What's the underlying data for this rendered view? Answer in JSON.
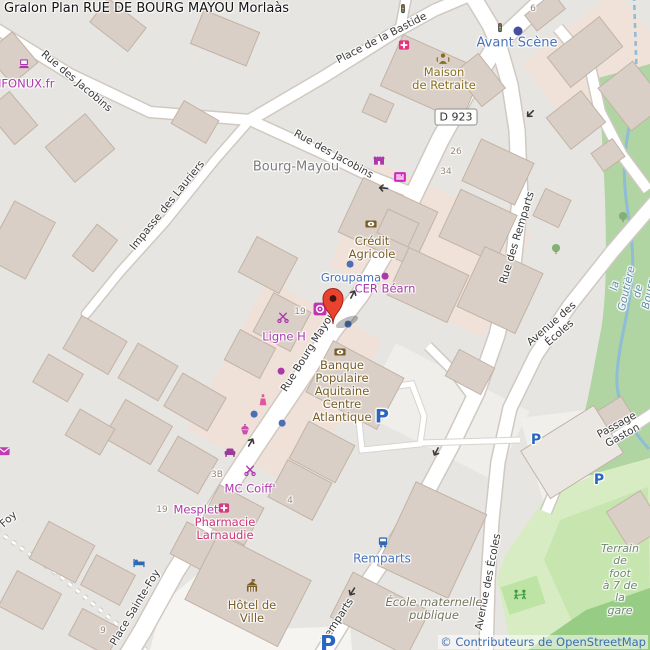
{
  "title": "Gralon Plan RUE DE BOURG MAYOU Morlaàs",
  "attribution": "© Contributeurs de OpenStreetMap",
  "road_shield": {
    "text": "D 923",
    "x": 456,
    "y": 117
  },
  "palette": {
    "shop_purple": "#ac39ac",
    "amenity_brown": "#7a5c25",
    "transport_blue": "#4a72b8",
    "pharmacy_pink": "#cc3377",
    "water_blue": "#5f8ca8",
    "marker_red": "#e7432e",
    "parking_blue": "#2a66c0",
    "attribution_blue": "#3b6eb5"
  },
  "labels": [
    {
      "name": "street-rue-des-jacobins-nw",
      "text": "Rue des Jacobins",
      "x": 76,
      "y": 82,
      "rot": 40,
      "color": "#3a3a3a",
      "size": 10.5
    },
    {
      "name": "street-impasse-des-lauriers",
      "text": "Impasse des Lauriers",
      "x": 168,
      "y": 206,
      "rot": -51,
      "color": "#3a3a3a",
      "size": 10.5
    },
    {
      "name": "street-place-de-la-bastide",
      "text": "Place de la Bastide",
      "x": 382,
      "y": 39,
      "rot": -27,
      "color": "#3a3a3a",
      "size": 10.5
    },
    {
      "name": "street-rue-des-jacobins-se",
      "text": "Rue des Jacobins",
      "x": 333,
      "y": 155,
      "rot": 29,
      "color": "#3a3a3a",
      "size": 10.5
    },
    {
      "name": "street-rue-bourg-mayou",
      "text": "Rue Bourg Mayou",
      "x": 309,
      "y": 352,
      "rot": -58,
      "color": "#3a3a3a",
      "size": 10.5
    },
    {
      "name": "street-place-sainte-foy",
      "text": "Place Sainte-Foy",
      "x": 136,
      "y": 608,
      "rot": -59,
      "color": "#3a3a3a",
      "size": 10.5
    },
    {
      "name": "street-foy",
      "text": "Foy",
      "x": 9,
      "y": 520,
      "rot": -42,
      "color": "#3a3a3a",
      "size": 10.5
    },
    {
      "name": "street-rue-des-remparts",
      "text": "Rue des Remparts",
      "x": 518,
      "y": 238,
      "rot": -73,
      "color": "#3a3a3a",
      "size": 10.5
    },
    {
      "name": "street-remparts",
      "text": "Remparts",
      "x": 338,
      "y": 621,
      "rot": -57,
      "color": "#3a3a3a",
      "size": 10.5
    },
    {
      "name": "street-avenue-des-ecoles-mid",
      "text": "Avenue des Écoles",
      "x": 556,
      "y": 329,
      "rot": -41,
      "color": "#3a3a3a",
      "size": 10.5
    },
    {
      "name": "street-avenue-des-ecoles-south",
      "text": "Avenue des Écoles",
      "x": 489,
      "y": 582,
      "rot": -79,
      "color": "#3a3a3a",
      "size": 10.5
    },
    {
      "name": "street-passage-gaston",
      "text": "Passage Gaston",
      "x": 620,
      "y": 431,
      "rot": -29,
      "color": "#3a3a3a",
      "size": 10.5
    },
    {
      "name": "place-bourg-mayou",
      "text": "Bourg-Mayou",
      "x": 296,
      "y": 168,
      "rot": 0,
      "color": "#7d7d7d",
      "size": 13
    },
    {
      "name": "poi-enfonux",
      "text": "ENFONUX.fr",
      "x": 20,
      "y": 84,
      "rot": 0,
      "color": "#ac39ac",
      "size": 11.5
    },
    {
      "name": "poi-avant-scene",
      "text": "Avant Scène",
      "x": 517,
      "y": 44,
      "rot": 0,
      "color": "#4a72b8",
      "size": 13
    },
    {
      "name": "poi-maison-de-retraite",
      "text": "Maison\nde Retraite",
      "x": 444,
      "y": 79,
      "rot": 0,
      "color": "#8a6d1f",
      "size": 11.5
    },
    {
      "name": "poi-credit-agricole",
      "text": "Crédit\nAgricole",
      "x": 372,
      "y": 248,
      "rot": 0,
      "color": "#7a5c25",
      "size": 11.5
    },
    {
      "name": "poi-groupama",
      "text": "Groupama",
      "x": 351,
      "y": 278,
      "rot": 0,
      "color": "#4a72b8",
      "size": 11.5
    },
    {
      "name": "poi-cer-bearn",
      "text": "CER Béarn",
      "x": 385,
      "y": 289,
      "rot": 0,
      "color": "#ac39ac",
      "size": 11.5
    },
    {
      "name": "poi-ligne-h",
      "text": "Ligne H",
      "x": 284,
      "y": 337,
      "rot": 0,
      "color": "#ac39ac",
      "size": 11.5
    },
    {
      "name": "poi-banque-populaire",
      "text": "Banque\nPopulaire\nAquitaine\nCentre\nAtlantique",
      "x": 342,
      "y": 391,
      "rot": 0,
      "color": "#7a5c25",
      "size": 11.5
    },
    {
      "name": "poi-mc-coiff",
      "text": "MC Coiff'",
      "x": 250,
      "y": 489,
      "rot": 0,
      "color": "#ac39ac",
      "size": 11.5
    },
    {
      "name": "poi-mesplet",
      "text": "Mesplet",
      "x": 196,
      "y": 510,
      "rot": 0,
      "color": "#ac39ac",
      "size": 11.5
    },
    {
      "name": "poi-pharmacie-larnaudie",
      "text": "Pharmacie\nLarnaudie",
      "x": 225,
      "y": 529,
      "rot": 0,
      "color": "#cc3377",
      "size": 11.5
    },
    {
      "name": "poi-hotel-de-ville",
      "text": "Hôtel de\nVille",
      "x": 252,
      "y": 612,
      "rot": 0,
      "color": "#7a5c25",
      "size": 11.5
    },
    {
      "name": "bus-stop-remparts",
      "text": "Remparts",
      "x": 382,
      "y": 559,
      "rot": 0,
      "color": "#4a72b8",
      "size": 12
    },
    {
      "name": "poi-ecole-maternelle",
      "text": "École maternelle\npublique",
      "x": 434,
      "y": 609,
      "rot": 0,
      "color": "#75755f",
      "size": 11.5,
      "italic": true
    },
    {
      "name": "poi-terrain-de-foot",
      "text": "Terrain\nde foot\nà 7 de la\ngare",
      "x": 620,
      "y": 580,
      "rot": 0,
      "color": "#6f8a6f",
      "size": 11,
      "italic": true
    },
    {
      "name": "water-la-goutiere",
      "text": "la Goutière de Bourg",
      "x": 633,
      "y": 290,
      "rot": -77,
      "color": "#5f8ca8",
      "size": 10.5,
      "italic": true
    },
    {
      "name": "housenumber",
      "text": "6",
      "x": 533,
      "y": 9,
      "rot": 0,
      "color": "#998877",
      "size": 9
    },
    {
      "name": "housenumber",
      "text": "26",
      "x": 456,
      "y": 152,
      "rot": 0,
      "color": "#998877",
      "size": 9
    },
    {
      "name": "housenumber",
      "text": "34",
      "x": 446,
      "y": 172,
      "rot": 0,
      "color": "#998877",
      "size": 9
    },
    {
      "name": "housenumber",
      "text": "19",
      "x": 300,
      "y": 312,
      "rot": 0,
      "color": "#998877",
      "size": 9
    },
    {
      "name": "housenumber",
      "text": "19",
      "x": 162,
      "y": 510,
      "rot": 0,
      "color": "#998877",
      "size": 9
    },
    {
      "name": "housenumber",
      "text": "3B",
      "x": 217,
      "y": 475,
      "rot": 0,
      "color": "#998877",
      "size": 9
    },
    {
      "name": "housenumber",
      "text": "4",
      "x": 290,
      "y": 501,
      "rot": 0,
      "color": "#998877",
      "size": 9
    },
    {
      "name": "housenumber",
      "text": "9",
      "x": 103,
      "y": 631,
      "rot": 0,
      "color": "#998877",
      "size": 9
    },
    {
      "name": "parking-p",
      "text": "P",
      "x": 382,
      "y": 417,
      "rot": 0,
      "color": "#2a66c0",
      "size": 19,
      "bold": true
    },
    {
      "name": "parking-p",
      "text": "P",
      "x": 536,
      "y": 441,
      "rot": 0,
      "color": "#2a66c0",
      "size": 14,
      "bold": true
    },
    {
      "name": "parking-p",
      "text": "P",
      "x": 599,
      "y": 481,
      "rot": 0,
      "color": "#2a66c0",
      "size": 14,
      "bold": true
    },
    {
      "name": "parking-p",
      "text": "P",
      "x": 328,
      "y": 646,
      "rot": 0,
      "color": "#2a66c0",
      "size": 22,
      "bold": true
    }
  ],
  "icons": [
    {
      "name": "laptop-icon",
      "x": 24,
      "y": 64
    },
    {
      "name": "clinic-icon",
      "x": 404,
      "y": 45
    },
    {
      "name": "social-facility-icon",
      "x": 443,
      "y": 59,
      "s": 15
    },
    {
      "name": "traffic-light-icon",
      "x": 403,
      "y": 9,
      "s": 11
    },
    {
      "name": "traffic-light-icon",
      "x": 500,
      "y": 28,
      "s": 11
    },
    {
      "name": "shop-awning-icon",
      "x": 379,
      "y": 160
    },
    {
      "name": "newsagent-icon",
      "x": 400,
      "y": 177,
      "s": 15
    },
    {
      "name": "bank-icon",
      "x": 371,
      "y": 224
    },
    {
      "name": "bank-icon",
      "x": 340,
      "y": 352
    },
    {
      "name": "hairdresser-icon",
      "x": 283,
      "y": 317
    },
    {
      "name": "convenience-icon",
      "x": 320,
      "y": 309,
      "s": 15
    },
    {
      "name": "beauty-icon",
      "x": 263,
      "y": 400
    },
    {
      "name": "bakery-icon",
      "x": 245,
      "y": 429
    },
    {
      "name": "furniture-icon",
      "x": 230,
      "y": 452
    },
    {
      "name": "post-icon",
      "x": 4,
      "y": 451
    },
    {
      "name": "hairdresser-icon",
      "x": 250,
      "y": 470
    },
    {
      "name": "pharmacy-icon",
      "x": 224,
      "y": 508
    },
    {
      "name": "hotel-icon",
      "x": 139,
      "y": 562
    },
    {
      "name": "townhall-icon",
      "x": 252,
      "y": 587,
      "s": 16
    },
    {
      "name": "bus-stop-icon",
      "x": 383,
      "y": 542,
      "s": 12
    },
    {
      "name": "playground-icon",
      "x": 520,
      "y": 594,
      "s": 16
    },
    {
      "name": "tree-icon",
      "x": 623,
      "y": 217
    },
    {
      "name": "tree-icon",
      "x": 556,
      "y": 249
    },
    {
      "name": "marker-pin",
      "x": 333,
      "y": 324
    }
  ],
  "dots": [
    {
      "x": 350,
      "y": 264,
      "color": "#4a6fb5",
      "r": 3.4
    },
    {
      "x": 348,
      "y": 324,
      "color": "#4a6fb5",
      "r": 3.4
    },
    {
      "x": 254,
      "y": 414,
      "color": "#4a6fb5",
      "r": 3.4
    },
    {
      "x": 282,
      "y": 423,
      "color": "#4a6fb5",
      "r": 3.4
    },
    {
      "x": 518,
      "y": 31,
      "color": "#454f9c",
      "r": 4.5
    },
    {
      "x": 385,
      "y": 276,
      "color": "#ac39ac",
      "r": 3.4
    },
    {
      "x": 281,
      "y": 371,
      "color": "#ac39ac",
      "r": 3.4
    }
  ],
  "oneway_arrows": [
    {
      "x": 353,
      "y": 294,
      "rot": -62
    },
    {
      "x": 251,
      "y": 442,
      "rot": -60
    },
    {
      "x": 530,
      "y": 114,
      "rot": 135
    },
    {
      "x": 436,
      "y": 452,
      "rot": 118
    },
    {
      "x": 383,
      "y": 188,
      "rot": 185
    },
    {
      "x": 352,
      "y": 592,
      "rot": 122
    }
  ]
}
